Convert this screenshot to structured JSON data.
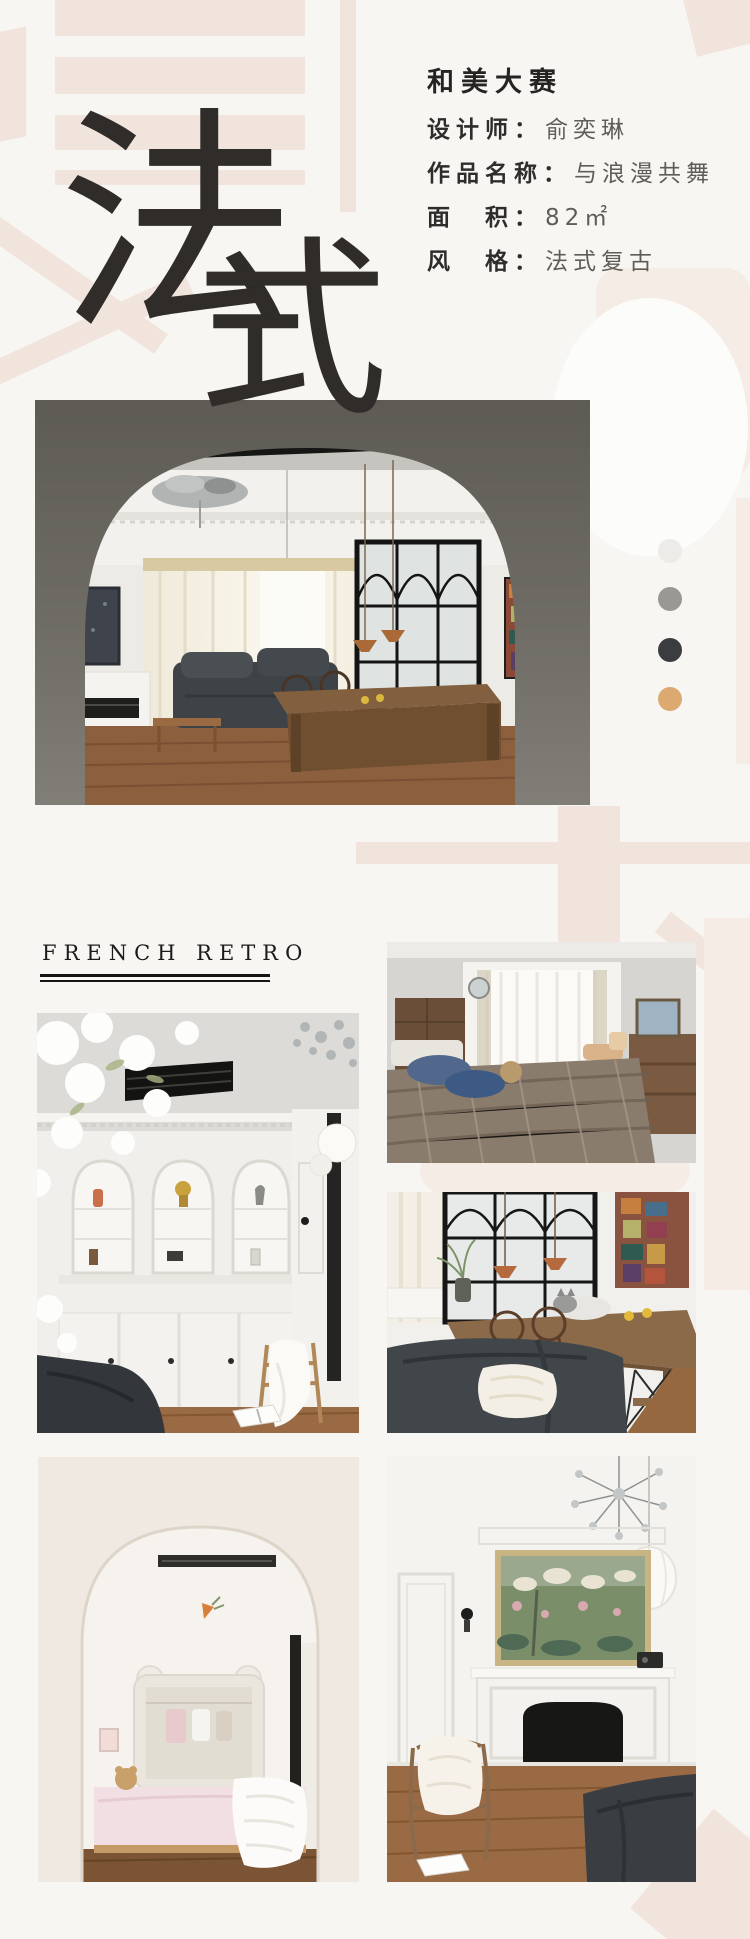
{
  "colors": {
    "page_bg": "#f8f6f2",
    "watermark": "#f1e4dc",
    "ink": "#2f2d2b",
    "value_gray": "#605d59"
  },
  "header": {
    "competition": "和美大赛",
    "rows": [
      {
        "label": "设计师：",
        "value": "俞奕琳"
      },
      {
        "label": "作品名称：",
        "value": "与浪漫共舞"
      },
      {
        "label": "面　积：",
        "value": "82㎡"
      },
      {
        "label": "风　格：",
        "value": "法式复古"
      }
    ]
  },
  "hero": {
    "char_fa": "法",
    "char_shi": "式"
  },
  "gallery": {
    "section_title": "FRENCH RETRO"
  },
  "palette": {
    "swatches": [
      {
        "name": "off-white",
        "hex": "#ecebe7"
      },
      {
        "name": "warm-gray",
        "hex": "#9b9792"
      },
      {
        "name": "charcoal",
        "hex": "#3b3c40"
      },
      {
        "name": "tan-gold",
        "hex": "#dcaa70"
      }
    ]
  }
}
